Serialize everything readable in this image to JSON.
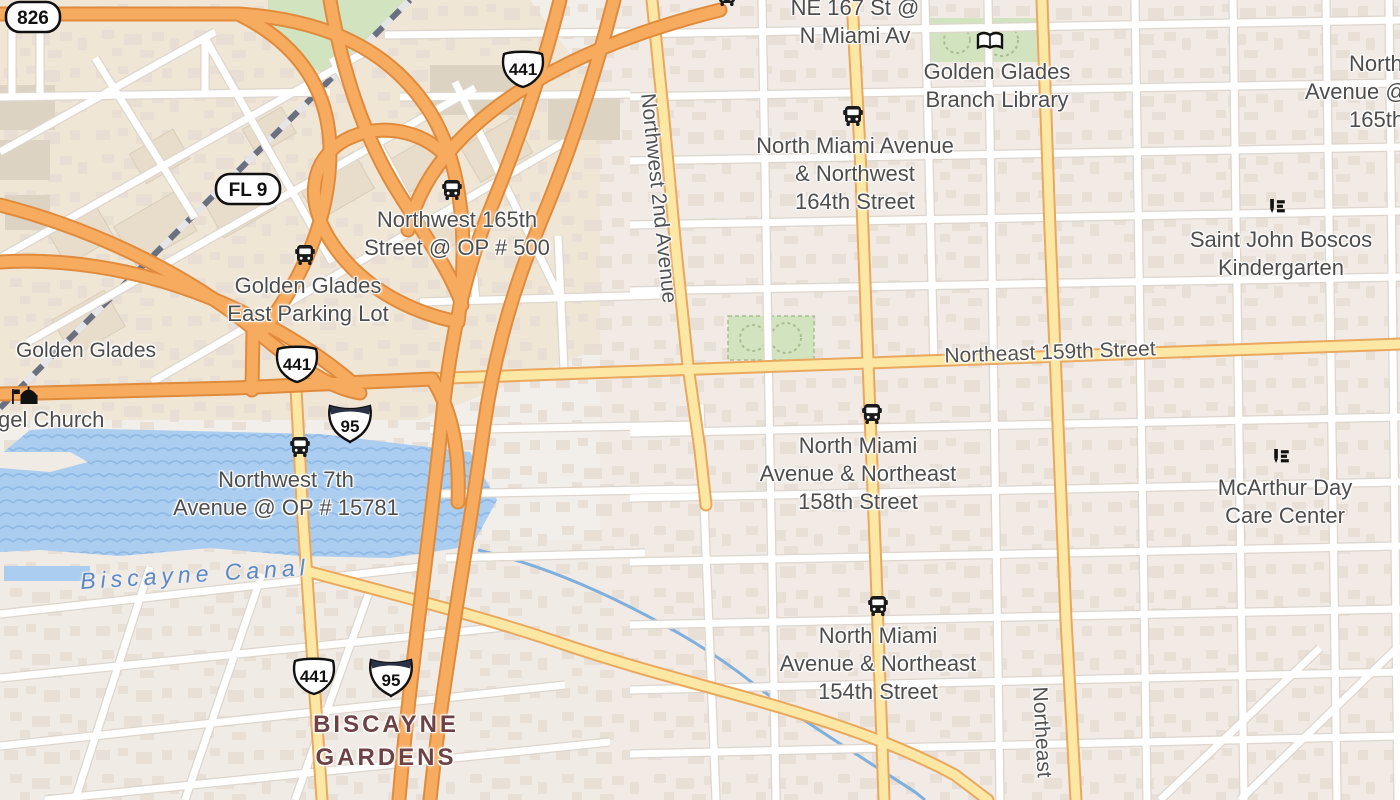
{
  "map": {
    "shields": {
      "s826": "826",
      "fl9": "FL 9",
      "us441": "441",
      "i95": "95"
    },
    "road_labels": {
      "ne159": "Northeast 159th Street",
      "nw2ave": "Northwest 2nd Avenue",
      "ne_vertical": "Northeast"
    },
    "place_labels": {
      "golden_glades": "Golden Glades",
      "biscayne_gardens_1": "BISCAYNE",
      "biscayne_gardens_2": "GARDENS",
      "biscayne_canal": "Biscayne Canal",
      "church": "gel Church"
    },
    "poi_labels": {
      "ne167": {
        "l1": "NE 167 St @",
        "l2": "N Miami Av"
      },
      "library": {
        "l1": "Golden Glades",
        "l2": "Branch Library"
      },
      "nm164": {
        "l1": "North Miami Avenue",
        "l2": "& Northwest",
        "l3": "164th Street"
      },
      "boscos": {
        "l1": "Saint John Boscos",
        "l2": "Kindergarten"
      },
      "nw165": {
        "l1": "Northwest 165th",
        "l2": "Street @ OP # 500"
      },
      "gg_parking": {
        "l1": "Golden Glades",
        "l2": "East Parking Lot"
      },
      "nw7": {
        "l1": "Northwest 7th",
        "l2": "Avenue @ OP # 15781"
      },
      "nm158": {
        "l1": "North Miami",
        "l2": "Avenue & Northeast",
        "l3": "158th Street"
      },
      "mcarthur": {
        "l1": "McArthur Day",
        "l2": "Care Center"
      },
      "nm154": {
        "l1": "North Miami",
        "l2": "Avenue & Northeast",
        "l3": "154th Street"
      },
      "edge_ne165": {
        "l1": "North",
        "l2": "Avenue @",
        "l3": "165th"
      }
    },
    "colors": {
      "motorway": "#f7ab5e",
      "motorway_casing": "#e08b3c",
      "road_yellow": "#fce8a4",
      "road_yellow_casing": "#eaa85f",
      "water": "#aacdf0",
      "park": "#d2e3c0",
      "label_gray": "#4d4d4d",
      "place_maroon": "#6e4145",
      "canal_blue": "#5c87c5",
      "interstate_navy": "#2b3147"
    }
  }
}
